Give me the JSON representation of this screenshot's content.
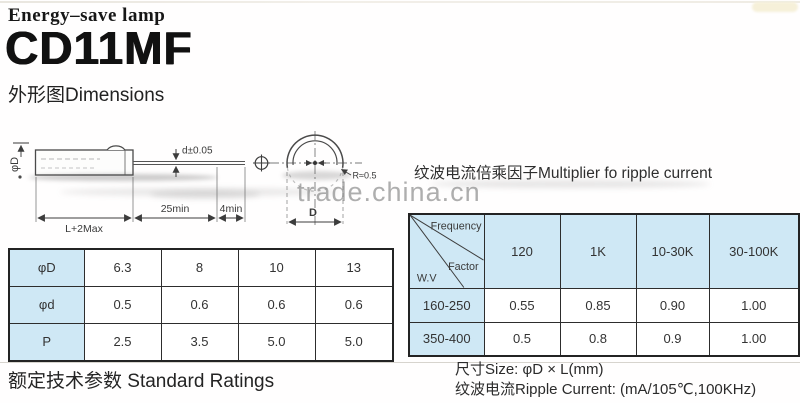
{
  "header": {
    "category": "Energy–save lamp",
    "model": "CD11MF",
    "section_dimensions": "外形图Dimensions"
  },
  "diagram": {
    "phi_d_body": "φD",
    "lead_tolerance": "d±0.05",
    "lead_min": "25min",
    "tip_min": "4min",
    "body_length": "L+2Max",
    "top_view_diameter": "D",
    "radius_note": "R≈0.5"
  },
  "ripple_section": {
    "heading": "纹波电流倍乘因子Multiplier fo ripple current"
  },
  "watermark": "trade.china.cn",
  "dimension_table": {
    "rows": [
      {
        "label": "φD",
        "values": [
          "6.3",
          "8",
          "10",
          "13"
        ]
      },
      {
        "label": "φd",
        "values": [
          "0.5",
          "0.6",
          "0.6",
          "0.6"
        ]
      },
      {
        "label": "P",
        "values": [
          "2.5",
          "3.5",
          "5.0",
          "5.0"
        ]
      }
    ]
  },
  "multiplier_table": {
    "corner": {
      "frequency": "Frequency",
      "factor": "Factor",
      "wv": "W.V"
    },
    "frequencies": [
      "120",
      "1K",
      "10-30K",
      "30-100K"
    ],
    "rows": [
      {
        "wv": "160-250",
        "values": [
          "0.55",
          "0.85",
          "0.90",
          "1.00"
        ]
      },
      {
        "wv": "350-400",
        "values": [
          "0.5",
          "0.8",
          "0.9",
          "1.00"
        ]
      }
    ]
  },
  "footer": {
    "standard_ratings": "额定技术参数 Standard Ratings",
    "size_note": "尺寸Size: φD × L(mm)",
    "ripple_note": "纹波电流Ripple Current: (mA/105℃,100KHz)"
  },
  "colors": {
    "table_header_bg": "#cfe8f5",
    "table_border": "#2d2d2d",
    "ink": "#1c1c1c",
    "watermark_gray": "#8c8c8c"
  }
}
